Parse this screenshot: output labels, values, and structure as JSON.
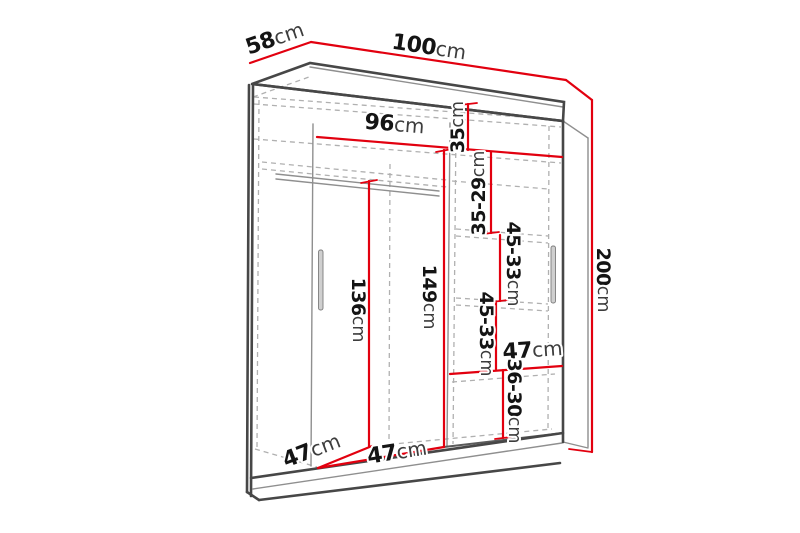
{
  "diagram_title": "Sliding-door wardrobe dimension diagram",
  "colors": {
    "dimension_line": "#e2000f",
    "outline": "#474747",
    "hidden_line": "#b0b0b0"
  },
  "dimensions": {
    "depth_top": {
      "value": "58",
      "unit": "cm"
    },
    "width_top": {
      "value": "100",
      "unit": "cm"
    },
    "height_right": {
      "value": "200",
      "unit": "cm"
    },
    "interior_width": {
      "value": "96",
      "unit": "cm"
    },
    "top_shelf_gap": {
      "value": "35",
      "unit": "cm"
    },
    "shelf_gap_1": {
      "value": "35-29",
      "unit": "cm"
    },
    "shelf_gap_2": {
      "value": "45-33",
      "unit": "cm"
    },
    "shelf_gap_3": {
      "value": "45-33",
      "unit": "cm"
    },
    "hanging_height": {
      "value": "136",
      "unit": "cm"
    },
    "middle_height": {
      "value": "149",
      "unit": "cm"
    },
    "shelf_width": {
      "value": "47",
      "unit": "cm"
    },
    "bottom_gap": {
      "value": "36-30",
      "unit": "cm"
    },
    "interior_depth": {
      "value": "47",
      "unit": "cm"
    },
    "left_section_width": {
      "value": "47",
      "unit": "cm"
    }
  }
}
